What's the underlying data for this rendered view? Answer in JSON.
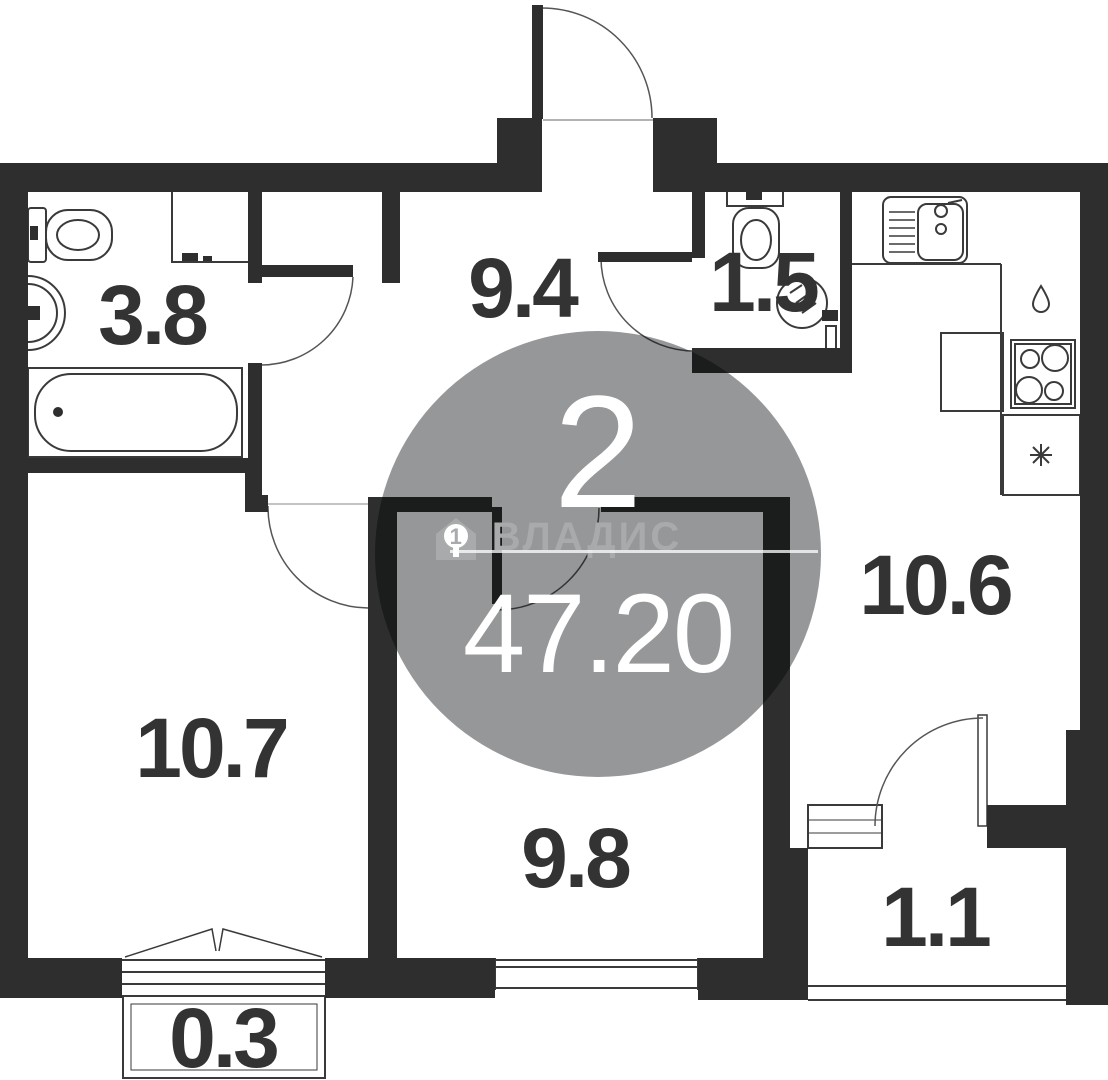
{
  "plan": {
    "type": "apartment-floor-plan",
    "watermark": {
      "rooms_count": "2",
      "brand": "ВЛАДИС",
      "brand_house_number": "1",
      "total_area": "47.20"
    },
    "rooms": [
      {
        "name": "bathroom",
        "area": "3.8"
      },
      {
        "name": "hallway",
        "area": "9.4"
      },
      {
        "name": "wc",
        "area": "1.5"
      },
      {
        "name": "kitchen",
        "area": "10.6"
      },
      {
        "name": "living-room",
        "area": "10.7"
      },
      {
        "name": "bedroom",
        "area": "9.8"
      },
      {
        "name": "balcony-right",
        "area": "1.1"
      },
      {
        "name": "balcony-bottom",
        "area": "0.3"
      }
    ],
    "fixtures": [
      "bathtub",
      "toilet",
      "washbasin",
      "niche",
      "wc-toilet",
      "corner-sink",
      "kitchen-sink",
      "stove",
      "counter",
      "fridge",
      "water-drop",
      "snowflake"
    ],
    "colors": {
      "wall": "#2e2e2e",
      "label": "#333333",
      "watermark_circle": "#969799",
      "watermark_text": "#ffffff",
      "brand": "#a8aaac"
    }
  }
}
